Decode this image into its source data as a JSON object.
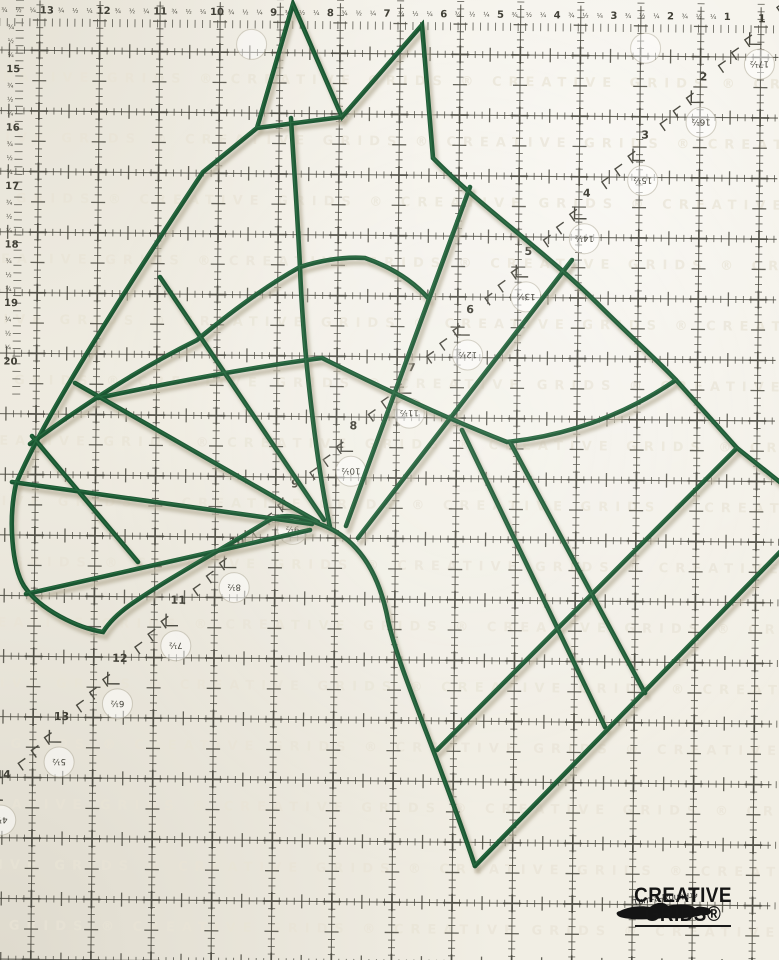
{
  "scene": {
    "description": "Green wire horse-head form lying on a Creative Grids quilting ruler grid",
    "mat_color": "#f1eee4",
    "grid_color": "#4b4a41",
    "label_color": "#403f36"
  },
  "ruler": {
    "grid": {
      "origin_x": 40,
      "origin_y": 50,
      "spacing_x": 60.1,
      "spacing_y": 60.6,
      "cols": 13,
      "rows": 16,
      "rotation_deg": 0.55,
      "edge_comb_y": 22,
      "edge_comb_x": 20
    },
    "top_edge": {
      "numbers": [
        14,
        13,
        12,
        11,
        10,
        9,
        8,
        7,
        6,
        5,
        4,
        3,
        2,
        1
      ],
      "fractions": [
        "¾",
        "½",
        "¼"
      ],
      "y": 13
    },
    "left_edge": {
      "numbers": [
        15,
        16,
        17,
        18,
        19,
        20
      ],
      "fractions": [
        "¾",
        "½",
        "¼"
      ],
      "x": 7,
      "start_y": 72,
      "step": 58.5
    },
    "diagonal": {
      "numbers": [
        1,
        2,
        3,
        4,
        5,
        6,
        7,
        8,
        9,
        10,
        11,
        12,
        13,
        14
      ],
      "half_labels": [
        "17½",
        "16½",
        "15½",
        "14½",
        "13½",
        "12½",
        "11½",
        "10½",
        "9½",
        "8½",
        "7½",
        "6½",
        "5½",
        "4½"
      ],
      "start_x": 762,
      "start_y": 15,
      "step_x": -57.8,
      "step_y": 58.7,
      "arrow_offsets": [
        [
          15,
          -15
        ],
        [
          28,
          -28
        ],
        [
          41,
          -41
        ]
      ],
      "bracket_offset": [
        -12,
        22
      ],
      "circle_offset": [
        -2,
        42
      ],
      "circle_radius": 15
    },
    "extra_circles": [
      [
        252,
        42
      ],
      [
        646,
        42
      ]
    ],
    "watermark": {
      "text": "CREATIVE GRIDS ® CREATIVE GRIDS ® CREATIVE GRIDS ® CREATIVE GRIDS ®",
      "color": "#e9e4d6"
    }
  },
  "wire": {
    "name": "horse-head-wire-frame",
    "color": "#1a5531",
    "highlight": "#2e7a4a",
    "shadow": "#b9b19c",
    "width": 4.6,
    "paths": {
      "outline_head": "M 16,484 C 45,415 125,290 203,172 L 257,128 L 293,4 L 342,117 L 422,25 L 433,158 C 482,208 546,252 598,304 C 634,340 655,358 676,380 L 737,448 L 781,483",
      "ear_base": "M 257,128 L 342,117",
      "outline_back_neck": "M 781,551 L 475,866",
      "outline_jaw": "M 475,866 C 438,755 398,668 388,620 C 380,578 362,543 327,527 C 303,517 283,511 266,522 C 228,546 170,577 130,605 C 116,615 108,624 103,632 C 78,628 40,610 24,586 C 12,567 8,520 16,484",
      "spoke_muzzle_top": "M 312,524 L 12,482",
      "spoke_muzzle_low": "M 310,530 L 26,594",
      "muzzle_rib": "M 32,436 L 138,562",
      "spoke_face_1": "M 318,522 L 75,383",
      "spoke_face_2": "M 324,520 L 160,277",
      "spoke_forehead": "M 330,527 C 316,460 303,350 300,267 C 297,205 293,155 291,118",
      "spoke_cheek_1": "M 346,526 L 470,187",
      "spoke_cheek_2": "M 358,538 L 572,260",
      "arc_outer": "M 30,444 Q 120,378 197,340 Q 255,292 300,267 Q 335,256 365,258 Q 405,272 429,299",
      "arc_inner": "M 98,398 Q 230,370 322,358 Q 430,412 507,442 Q 600,432 676,380",
      "neck_rib_long": "M 737,448 L 437,750",
      "neck_spoke_1": "M 462,430 L 605,727",
      "neck_spoke_2": "M 510,442 L 645,693"
    }
  },
  "logo": {
    "tagline": "Turn-a-Round™",
    "brand_line1": "CREATIVE",
    "brand_line2": "GRIDS®"
  }
}
